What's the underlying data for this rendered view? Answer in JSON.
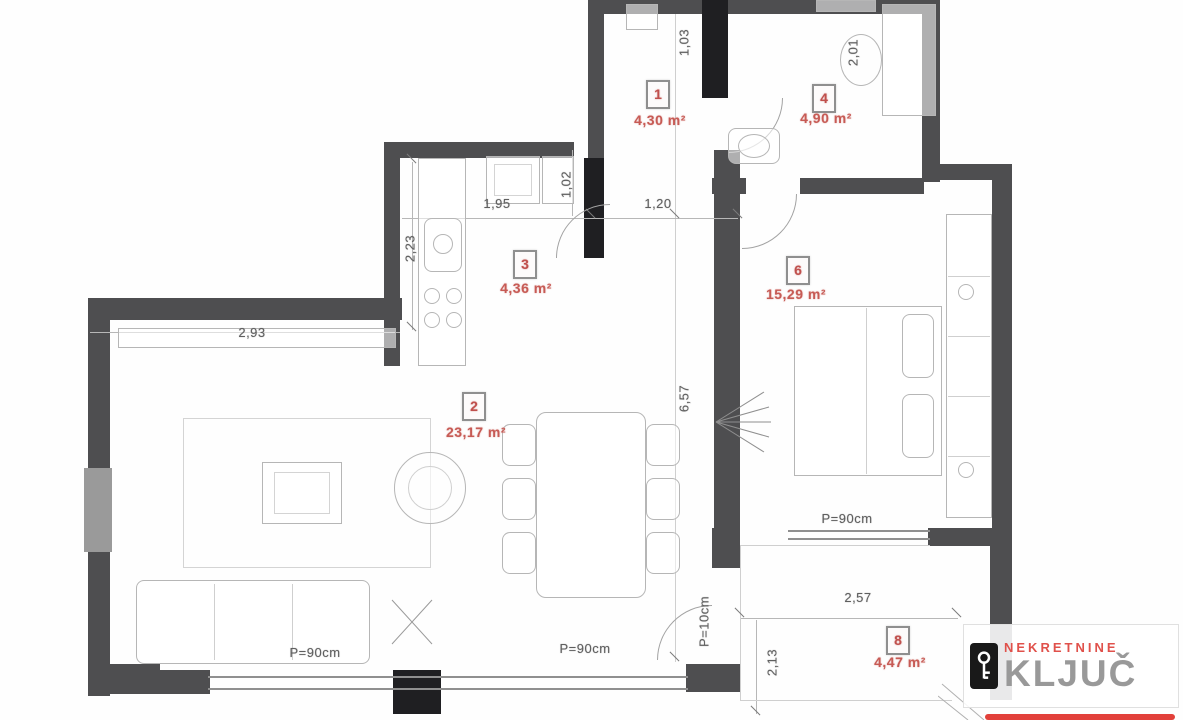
{
  "colors": {
    "wall_gray": "#4e4e50",
    "wall_black": "#1f1f22",
    "room_label_red": "#c75b55",
    "dimension_gray": "#5f5f5f",
    "logo_red": "#e2403a",
    "logo_gray": "#999999"
  },
  "plan": {
    "rooms": [
      {
        "num": "1",
        "area": "4,30 m²"
      },
      {
        "num": "4",
        "area": "4,90 m²"
      },
      {
        "num": "3",
        "area": "4,36 m²"
      },
      {
        "num": "2",
        "area": "23,17 m²"
      },
      {
        "num": "6",
        "area": "15,29 m²"
      },
      {
        "num": "8",
        "area": "4,47 m²"
      }
    ],
    "dimensions": [
      {
        "text": "1,95",
        "orientation": "h"
      },
      {
        "text": "1,02",
        "orientation": "v"
      },
      {
        "text": "1,20",
        "orientation": "h"
      },
      {
        "text": "1,03",
        "orientation": "v"
      },
      {
        "text": "2,01",
        "orientation": "v"
      },
      {
        "text": "2,23",
        "orientation": "v"
      },
      {
        "text": "2,93",
        "orientation": "h"
      },
      {
        "text": "6,57",
        "orientation": "v"
      },
      {
        "text": "2,57",
        "orientation": "h"
      },
      {
        "text": "2,13",
        "orientation": "v"
      },
      {
        "text": "P=90cm",
        "orientation": "h"
      },
      {
        "text": "P=90cm",
        "orientation": "h"
      },
      {
        "text": "P=90cm",
        "orientation": "h"
      },
      {
        "text": "P=10cm",
        "orientation": "v"
      }
    ]
  },
  "watermark": {
    "agency_label": "NEKRETNINE",
    "agency_name": "KLJUČ",
    "icon": "key-icon"
  }
}
